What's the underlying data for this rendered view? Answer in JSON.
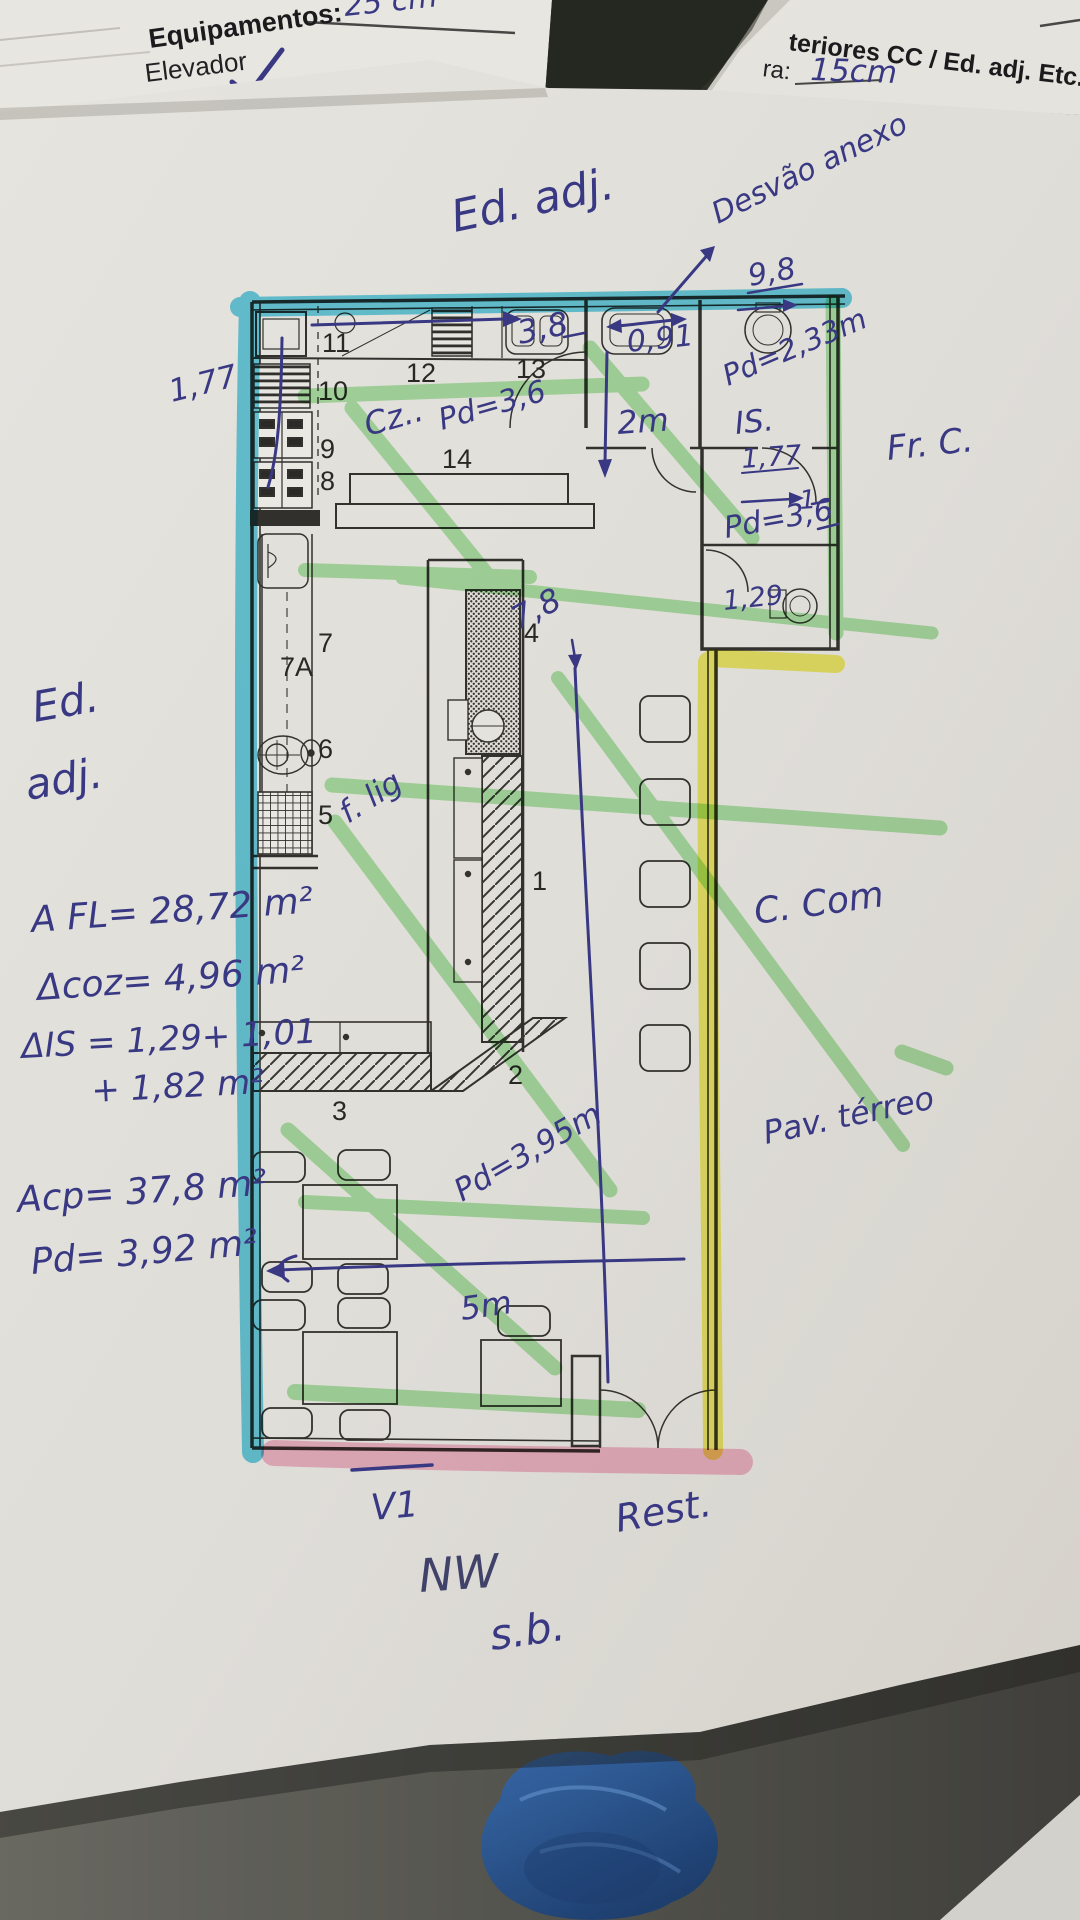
{
  "colors": {
    "highlight_cyan": "#3cc3e2",
    "highlight_green": "#7fd878",
    "highlight_yellow": "#f2ee49",
    "highlight_pink": "#f6aec8",
    "pen_blue": "#3b3a88",
    "plan_ink": "#35332f",
    "paper": "#e8e6e0"
  },
  "header_left": {
    "stack_note": "25 cm",
    "title": "Equipamentos:",
    "item1": "Elevador",
    "item2": "Rede de Gá"
  },
  "header_right": {
    "title": "teriores CC / Ed. adj. Etc.:",
    "field_label": "ra:",
    "field_value": "15cm"
  },
  "rooms": {
    "n1": "1",
    "n2": "2",
    "n3": "3",
    "n4": "4",
    "n5": "5",
    "n6": "6",
    "n7": "7",
    "n7a": "7A",
    "n8": "8",
    "n9": "9",
    "n10": "10",
    "n11": "11",
    "n12": "12",
    "n13": "13",
    "n14": "14"
  },
  "notes_top": {
    "ed_adj": "Ed. adj.",
    "desvao": "Desvão anexo",
    "w98": "9,8",
    "w38": "3,8",
    "cz": "Cz..",
    "pd36": "Pd=3,6",
    "w2m": "2m",
    "w091": "0,91",
    "pd233": "Pd=2,33m",
    "is_label": "IS.",
    "w177": "1,77",
    "one": "1",
    "pd36b": "Pd=3,6",
    "w129": "1,29"
  },
  "notes_mid": {
    "w78": "7,8",
    "flig": "f. lig",
    "pd395": "Pd=3,95m",
    "w5m": "5m"
  },
  "notes_left": {
    "w177": "1,77",
    "ed": "Ed.",
    "adj": "adj.",
    "afl": "A FL= 28,72 m²",
    "acoz": "Δcoz= 4,96 m²",
    "ais1": "ΔIS = 1,29+ 1,01",
    "ais2": "+ 1,82 m²",
    "acp": "Acp= 37,8 m²",
    "pd392": "Pd= 3,92 m²"
  },
  "notes_right": {
    "frc": "Fr. C.",
    "ccom": "C. Com",
    "pav": "Pav. térreo"
  },
  "notes_bottom": {
    "v1": "V1",
    "rest": "Rest.",
    "nw": "NW",
    "sb": "s.b."
  }
}
